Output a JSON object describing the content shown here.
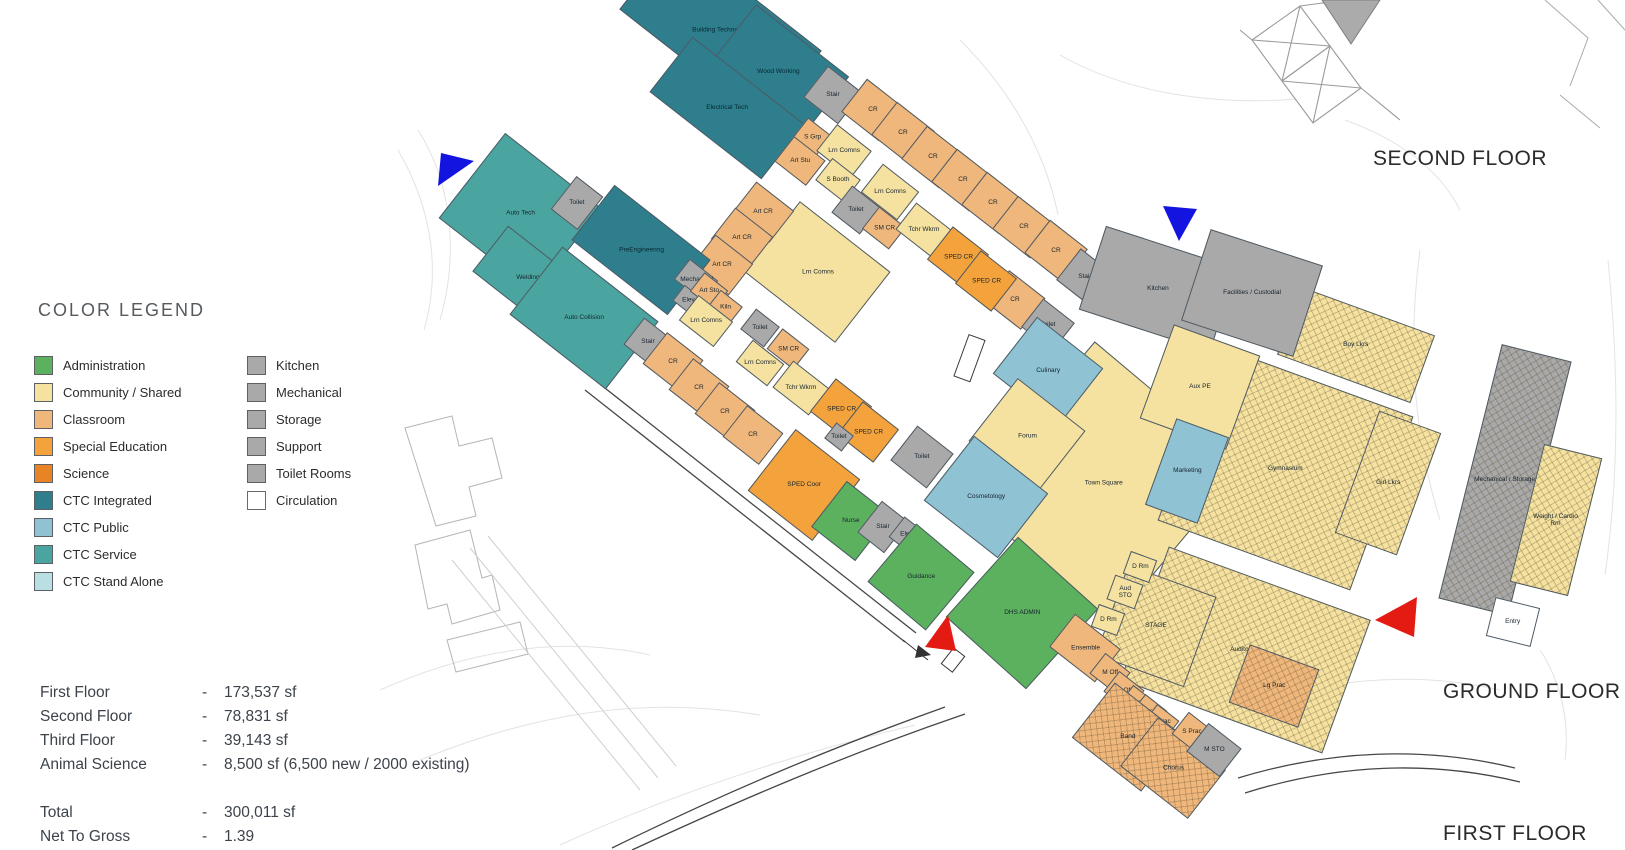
{
  "legend": {
    "title": "COLOR LEGEND",
    "col1": [
      {
        "label": "Administration",
        "color": "#5bb15e"
      },
      {
        "label": "Community / Shared",
        "color": "#f6e2a0"
      },
      {
        "label": "Classroom",
        "color": "#f0b77c"
      },
      {
        "label": "Special Education",
        "color": "#f4a33c"
      },
      {
        "label": "Science",
        "color": "#e98426"
      },
      {
        "label": "CTC Integrated",
        "color": "#2f7e8e"
      },
      {
        "label": "CTC Public",
        "color": "#8fc3d4"
      },
      {
        "label": "CTC Service",
        "color": "#4aa5a0"
      },
      {
        "label": "CTC Stand Alone",
        "color": "#b9dfe3"
      }
    ],
    "col2": [
      {
        "label": "Kitchen",
        "color": "#a9a9a9"
      },
      {
        "label": "Mechanical",
        "color": "#a9a9a9"
      },
      {
        "label": "Storage",
        "color": "#a9a9a9"
      },
      {
        "label": "Support",
        "color": "#a9a9a9"
      },
      {
        "label": "Toilet Rooms",
        "color": "#a9a9a9"
      },
      {
        "label": "Circulation",
        "color": "#ffffff",
        "outlined": true
      }
    ]
  },
  "stats": {
    "rows": [
      {
        "label": "First Floor",
        "dash": "-",
        "value": "173,537 sf"
      },
      {
        "label": "Second Floor",
        "dash": "-",
        "value": "78,831 sf"
      },
      {
        "label": "Third Floor",
        "dash": "-",
        "value": "39,143 sf"
      },
      {
        "label": "Animal Science",
        "dash": "-",
        "value": "8,500 sf (6,500 new / 2000 existing)"
      },
      {
        "label": "Total",
        "dash": "-",
        "value": "300,011 sf",
        "gap": true
      },
      {
        "label": "Net To Gross",
        "dash": "-",
        "value": "1.39"
      }
    ]
  },
  "floors": {
    "second": "SECOND FLOOR",
    "ground": "GROUND FLOOR",
    "first": "FIRST FLOOR"
  },
  "markers": [
    {
      "name": "blue-triangle-west",
      "color": "#1414e0",
      "points": "438,186 441,153 474,161"
    },
    {
      "name": "blue-triangle-north",
      "color": "#1414e0",
      "points": "1163,206 1197,209 1179,241"
    },
    {
      "name": "red-triangle-south",
      "color": "#e41b13",
      "points": "925,647 948,615 956,651"
    },
    {
      "name": "red-triangle-east",
      "color": "#e41b13",
      "points": "1375,620 1417,597 1414,637"
    }
  ],
  "plan": {
    "rooms": [
      {
        "l": "Building Technology",
        "c": "ctci",
        "x": 720,
        "y": 30,
        "w": 185,
        "h": 92,
        "r": 38
      },
      {
        "l": "Wood Working",
        "c": "ctci",
        "x": 778,
        "y": 72,
        "w": 118,
        "h": 80,
        "r": 38
      },
      {
        "l": "Electrical Tech",
        "c": "ctci",
        "x": 727,
        "y": 108,
        "w": 142,
        "h": 70,
        "r": 38
      },
      {
        "l": "Stair",
        "c": "gray",
        "x": 833,
        "y": 95,
        "w": 44,
        "h": 40,
        "r": 38
      },
      {
        "l": "CR",
        "c": "classroom",
        "x": 873,
        "y": 110,
        "w": 48,
        "h": 42,
        "r": 38
      },
      {
        "l": "CR",
        "c": "classroom",
        "x": 903,
        "y": 133,
        "w": 48,
        "h": 42,
        "r": 38
      },
      {
        "l": "CR",
        "c": "classroom",
        "x": 933,
        "y": 157,
        "w": 48,
        "h": 42,
        "r": 38
      },
      {
        "l": "CR",
        "c": "classroom",
        "x": 963,
        "y": 180,
        "w": 48,
        "h": 42,
        "r": 38
      },
      {
        "l": "CR",
        "c": "classroom",
        "x": 993,
        "y": 203,
        "w": 48,
        "h": 42,
        "r": 38
      },
      {
        "l": "CR",
        "c": "classroom",
        "x": 1024,
        "y": 227,
        "w": 48,
        "h": 42,
        "r": 38
      },
      {
        "l": "CR",
        "c": "classroom",
        "x": 1056,
        "y": 251,
        "w": 48,
        "h": 42,
        "r": 38
      },
      {
        "l": "CR",
        "c": "classroom",
        "x": 1015,
        "y": 300,
        "w": 46,
        "h": 40,
        "r": 38
      },
      {
        "l": "Stair",
        "c": "gray",
        "x": 1085,
        "y": 277,
        "w": 42,
        "h": 40,
        "r": 38
      },
      {
        "l": "Toilet",
        "c": "gray",
        "x": 1048,
        "y": 325,
        "w": 40,
        "h": 36,
        "r": 38
      },
      {
        "l": "Lrn Comns",
        "c": "community",
        "x": 817,
        "y": 272,
        "w": 115,
        "h": 90,
        "r": 38
      },
      {
        "l": "S Grp",
        "c": "classroom",
        "x": 812,
        "y": 137,
        "w": 30,
        "h": 26,
        "r": 38
      },
      {
        "l": "Lrn Comns",
        "c": "community",
        "x": 844,
        "y": 151,
        "w": 44,
        "h": 34,
        "r": 38
      },
      {
        "l": "Art Stu",
        "c": "classroom",
        "x": 800,
        "y": 161,
        "w": 40,
        "h": 32,
        "r": 38
      },
      {
        "l": "S Booth",
        "c": "community",
        "x": 838,
        "y": 180,
        "w": 36,
        "h": 28,
        "r": 38
      },
      {
        "l": "Lrn Comns",
        "c": "community",
        "x": 890,
        "y": 192,
        "w": 46,
        "h": 36,
        "r": 38
      },
      {
        "l": "Toilet",
        "c": "gray",
        "x": 856,
        "y": 210,
        "w": 36,
        "h": 34,
        "r": 38
      },
      {
        "l": "SM CR",
        "c": "classroom",
        "x": 884,
        "y": 228,
        "w": 34,
        "h": 28,
        "r": 38
      },
      {
        "l": "Tchr Wkrm",
        "c": "community",
        "x": 924,
        "y": 230,
        "w": 46,
        "h": 34,
        "r": 38
      },
      {
        "l": "SPED CR",
        "c": "sped",
        "x": 958,
        "y": 257,
        "w": 46,
        "h": 42,
        "r": 38
      },
      {
        "l": "SPED CR",
        "c": "sped",
        "x": 986,
        "y": 281,
        "w": 46,
        "h": 42,
        "r": 38
      },
      {
        "l": "Art CR",
        "c": "classroom",
        "x": 763,
        "y": 212,
        "w": 48,
        "h": 40,
        "r": 38
      },
      {
        "l": "Art CR",
        "c": "classroom",
        "x": 742,
        "y": 238,
        "w": 48,
        "h": 40,
        "r": 38
      },
      {
        "l": "Art CR",
        "c": "classroom",
        "x": 722,
        "y": 265,
        "w": 48,
        "h": 40,
        "r": 38
      },
      {
        "l": "Auto Tech",
        "c": "ctcs",
        "x": 520,
        "y": 213,
        "w": 122,
        "h": 108,
        "r": 38
      },
      {
        "l": "Toilet",
        "c": "gray",
        "x": 577,
        "y": 203,
        "w": 34,
        "h": 42,
        "r": 38
      },
      {
        "l": "Welding",
        "c": "ctcs",
        "x": 528,
        "y": 278,
        "w": 96,
        "h": 58,
        "r": 38
      },
      {
        "l": "Auto Collision",
        "c": "ctcs",
        "x": 584,
        "y": 318,
        "w": 122,
        "h": 86,
        "r": 38
      },
      {
        "l": "PreEngineering",
        "c": "ctci",
        "x": 641,
        "y": 250,
        "w": 122,
        "h": 70,
        "r": 38
      },
      {
        "l": "Mechanical",
        "c": "gray",
        "x": 696,
        "y": 280,
        "w": 36,
        "h": 26,
        "r": 38
      },
      {
        "l": "Elev",
        "c": "gray",
        "x": 688,
        "y": 300,
        "w": 24,
        "h": 20,
        "r": 38
      },
      {
        "l": "Art Sto",
        "c": "classroom",
        "x": 709,
        "y": 291,
        "w": 30,
        "h": 24,
        "r": 38
      },
      {
        "l": "Kiln",
        "c": "classroom",
        "x": 725,
        "y": 307,
        "w": 28,
        "h": 22,
        "r": 38
      },
      {
        "l": "Lrn Comns",
        "c": "community",
        "x": 706,
        "y": 321,
        "w": 44,
        "h": 32,
        "r": 38
      },
      {
        "l": "Stair",
        "c": "gray",
        "x": 648,
        "y": 342,
        "w": 36,
        "h": 34,
        "r": 38
      },
      {
        "l": "CR",
        "c": "classroom",
        "x": 673,
        "y": 362,
        "w": 46,
        "h": 40,
        "r": 38
      },
      {
        "l": "CR",
        "c": "classroom",
        "x": 699,
        "y": 388,
        "w": 46,
        "h": 40,
        "r": 38
      },
      {
        "l": "CR",
        "c": "classroom",
        "x": 725,
        "y": 412,
        "w": 46,
        "h": 40,
        "r": 38
      },
      {
        "l": "CR",
        "c": "classroom",
        "x": 753,
        "y": 435,
        "w": 46,
        "h": 40,
        "r": 38
      },
      {
        "l": "Toilet",
        "c": "gray",
        "x": 760,
        "y": 328,
        "w": 30,
        "h": 26,
        "r": 38
      },
      {
        "l": "SM CR",
        "c": "classroom",
        "x": 788,
        "y": 349,
        "w": 34,
        "h": 26,
        "r": 38
      },
      {
        "l": "Lrn Comns",
        "c": "community",
        "x": 760,
        "y": 363,
        "w": 40,
        "h": 28,
        "r": 38
      },
      {
        "l": "Tchr Wkrm",
        "c": "community",
        "x": 801,
        "y": 388,
        "w": 46,
        "h": 34,
        "r": 38
      },
      {
        "l": "SPED CR",
        "c": "sped",
        "x": 841,
        "y": 409,
        "w": 46,
        "h": 42,
        "r": 38
      },
      {
        "l": "SPED CR",
        "c": "sped",
        "x": 868,
        "y": 432,
        "w": 46,
        "h": 42,
        "r": 38
      },
      {
        "l": "Toilet",
        "c": "gray",
        "x": 839,
        "y": 437,
        "w": 22,
        "h": 20,
        "r": 38
      },
      {
        "l": "Town Square",
        "c": "community",
        "x": 1103,
        "y": 482,
        "w": 195,
        "h": 205,
        "r": 40
      },
      {
        "l": "Gymnasium",
        "c": "community",
        "t": 1,
        "x": 1285,
        "y": 468,
        "w": 205,
        "h": 185,
        "r": 20
      },
      {
        "l": "Auditorium",
        "c": "community",
        "t": 1,
        "x": 1245,
        "y": 650,
        "w": 215,
        "h": 142,
        "r": 20
      },
      {
        "l": "Boy Lkrs",
        "c": "community",
        "t": 1,
        "x": 1356,
        "y": 345,
        "w": 142,
        "h": 72,
        "r": 20
      },
      {
        "l": "Girl Lkrs",
        "c": "community",
        "t": 1,
        "x": 1388,
        "y": 483,
        "w": 66,
        "h": 130,
        "r": 20
      },
      {
        "l": "Kitchen",
        "c": "gray",
        "x": 1158,
        "y": 289,
        "w": 138,
        "h": 88,
        "r": 18
      },
      {
        "l": "Facilities / Custodial",
        "c": "gray",
        "x": 1252,
        "y": 293,
        "w": 118,
        "h": 96,
        "r": 18
      },
      {
        "l": "Aux PE",
        "c": "community",
        "x": 1200,
        "y": 387,
        "w": 92,
        "h": 100,
        "r": 20
      },
      {
        "l": "Marketing",
        "c": "ctcp",
        "x": 1187,
        "y": 471,
        "w": 56,
        "h": 92,
        "r": 20
      },
      {
        "l": "Culinary",
        "c": "ctcp",
        "x": 1048,
        "y": 371,
        "w": 84,
        "h": 72,
        "r": 38
      },
      {
        "l": "Forum",
        "c": "community",
        "x": 1027,
        "y": 436,
        "w": 86,
        "h": 80,
        "r": 38
      },
      {
        "l": "Toilet",
        "c": "gray",
        "x": 922,
        "y": 457,
        "w": 46,
        "h": 44,
        "r": 38
      },
      {
        "l": "Cosmetology",
        "c": "ctcp",
        "x": 986,
        "y": 497,
        "w": 94,
        "h": 82,
        "r": 38
      },
      {
        "l": "SPED Coor",
        "c": "sped",
        "x": 804,
        "y": 485,
        "w": 82,
        "h": 78,
        "r": 38
      },
      {
        "l": "Nurse",
        "c": "admin",
        "x": 851,
        "y": 521,
        "w": 56,
        "h": 58,
        "r": 38
      },
      {
        "l": "Stair",
        "c": "gray",
        "x": 883,
        "y": 527,
        "w": 34,
        "h": 40,
        "r": 38
      },
      {
        "l": "Elev",
        "c": "gray",
        "x": 906,
        "y": 534,
        "w": 24,
        "h": 26,
        "r": 38
      },
      {
        "l": "Guidance",
        "c": "admin",
        "x": 921,
        "y": 577,
        "w": 76,
        "h": 76,
        "r": 40
      },
      {
        "l": "DHS ADMIN",
        "c": "admin",
        "x": 1022,
        "y": 613,
        "w": 108,
        "h": 108,
        "r": 42
      },
      {
        "l": "STAGE",
        "c": "community",
        "t": 1,
        "x": 1156,
        "y": 626,
        "w": 94,
        "h": 96,
        "r": 20
      },
      {
        "l": "D Rm",
        "c": "community",
        "x": 1140,
        "y": 567,
        "w": 28,
        "h": 24,
        "r": 20
      },
      {
        "l": "Aud STO",
        "c": "community",
        "x": 1125,
        "y": 592,
        "w": 30,
        "h": 26,
        "r": 20
      },
      {
        "l": "D Rm",
        "c": "community",
        "x": 1108,
        "y": 620,
        "w": 28,
        "h": 24,
        "r": 20
      },
      {
        "l": "Lg Prac",
        "c": "classroom",
        "t": 1,
        "x": 1274,
        "y": 686,
        "w": 74,
        "h": 62,
        "r": 20
      },
      {
        "l": "Ensemble",
        "c": "classroom",
        "x": 1085,
        "y": 648,
        "w": 58,
        "h": 42,
        "r": 38
      },
      {
        "l": "M Off",
        "c": "classroom",
        "x": 1110,
        "y": 673,
        "w": 32,
        "h": 26,
        "r": 38
      },
      {
        "l": "M Off",
        "c": "classroom",
        "x": 1124,
        "y": 691,
        "w": 32,
        "h": 26,
        "r": 38
      },
      {
        "l": "S Prac",
        "c": "classroom",
        "x": 1137,
        "y": 703,
        "w": 28,
        "h": 24,
        "r": 38
      },
      {
        "l": "S Prac",
        "c": "classroom",
        "x": 1149,
        "y": 712,
        "w": 28,
        "h": 24,
        "r": 38
      },
      {
        "l": "S Prac",
        "c": "classroom",
        "x": 1161,
        "y": 722,
        "w": 28,
        "h": 24,
        "r": 38
      },
      {
        "l": "Band",
        "c": "classroom",
        "t": 1,
        "x": 1128,
        "y": 737,
        "w": 88,
        "h": 70,
        "r": 38
      },
      {
        "l": "Chorus",
        "c": "classroom",
        "t": 1,
        "x": 1173,
        "y": 768,
        "w": 86,
        "h": 62,
        "r": 38
      },
      {
        "l": "S Prac",
        "c": "classroom",
        "x": 1192,
        "y": 732,
        "w": 30,
        "h": 28,
        "r": 38
      },
      {
        "l": "M STO",
        "c": "gray",
        "x": 1214,
        "y": 750,
        "w": 42,
        "h": 36,
        "r": 38
      },
      {
        "l": "Mechanical / Storage",
        "c": "gray",
        "t": 1,
        "x": 1505,
        "y": 480,
        "w": 72,
        "h": 262,
        "r": 14
      },
      {
        "l": "Weight / Cardio Rm",
        "c": "community",
        "t": 1,
        "x": 1556,
        "y": 520,
        "w": 60,
        "h": 142,
        "r": 14
      },
      {
        "l": "Entry",
        "c": "white",
        "x": 1513,
        "y": 622,
        "w": 46,
        "h": 40,
        "r": 14
      }
    ]
  }
}
